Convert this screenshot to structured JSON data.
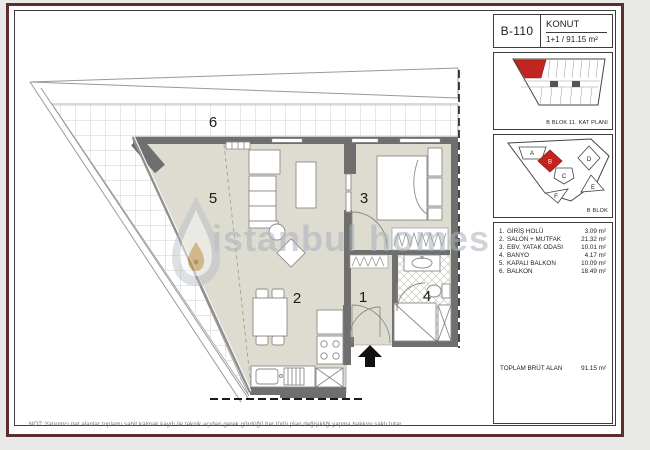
{
  "header": {
    "unit_code": "B-110",
    "type_label": "KONUT",
    "layout_label": "1+1 / 91.15 m²"
  },
  "key_plan": {
    "caption": "B BLOK 11. KAT PLANI"
  },
  "site_plan": {
    "caption": "B BLOK",
    "blocks": [
      "A",
      "B",
      "C",
      "D",
      "E",
      "F"
    ]
  },
  "room_list": {
    "items": [
      {
        "no": "1.",
        "name": "GİRİŞ HOLÜ",
        "area": "3.09 m²"
      },
      {
        "no": "2.",
        "name": "SALON + MUTFAK",
        "area": "21.32 m²"
      },
      {
        "no": "3.",
        "name": "EBV. YATAK ODASI",
        "area": "10.01 m²"
      },
      {
        "no": "4.",
        "name": "BANYO",
        "area": "4.17 m²"
      },
      {
        "no": "5.",
        "name": "KAPALI BALKON",
        "area": "10.09 m²"
      },
      {
        "no": "6.",
        "name": "BALKON",
        "area": "18.49 m²"
      }
    ],
    "total_label": "TOPLAM BRÜT ALAN",
    "total_value": "91.15 m²"
  },
  "plan": {
    "room_numbers": [
      "1",
      "2",
      "3",
      "4",
      "5",
      "6"
    ],
    "watermark_text": "istanbul homes"
  },
  "note": "NOT: Yatırımcı net alanlar toplamı sabit kalmak kaydı ile teknik açıdan gerek gördüğü her türlü plan değişikliği yapma hakkını saklı tutar.",
  "colors": {
    "frame": "#5d2e2e",
    "floor": "#dedcd0",
    "wall": "#6f6f6f",
    "highlight": "#c22520",
    "grid_line": "#cfcfcf",
    "watermark": "#a9b2bb"
  }
}
